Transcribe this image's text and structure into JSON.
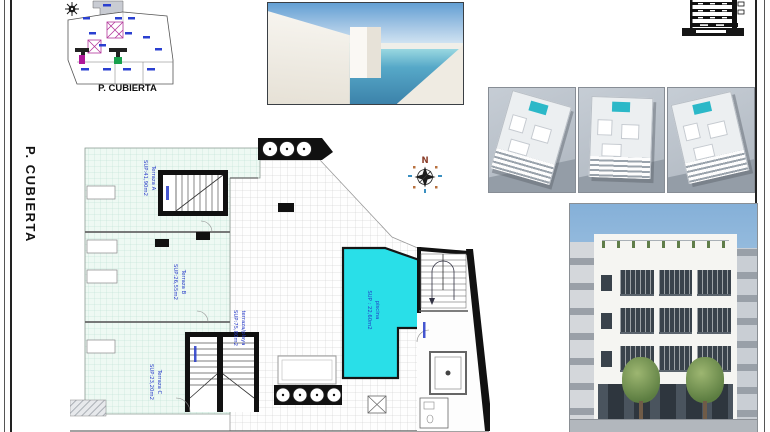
{
  "sheet": {
    "side_label": "P. CUBIERTA",
    "mini_plan_caption": "P. CUBIERTA",
    "compass_north": "N"
  },
  "plan_labels": {
    "terraza_a": {
      "name": "Terraza A",
      "area": "SUP:41,90m2"
    },
    "terraza_b": {
      "name": "Terraza B",
      "area": "SUP:26,55m2"
    },
    "terraza_c": {
      "name": "Terraza C",
      "area": "SUP:23,20m2"
    },
    "terraza_playa": {
      "name": "terraza/playa",
      "area": "SUP:75,80m2"
    },
    "piscina": {
      "name": "piscina",
      "area": "SUP : 22,60m2"
    }
  },
  "colors": {
    "pool": "#29DFE8",
    "label_blue": "#2438C8",
    "tile_teal": "#EEF9F3",
    "wall_black": "#111111"
  }
}
